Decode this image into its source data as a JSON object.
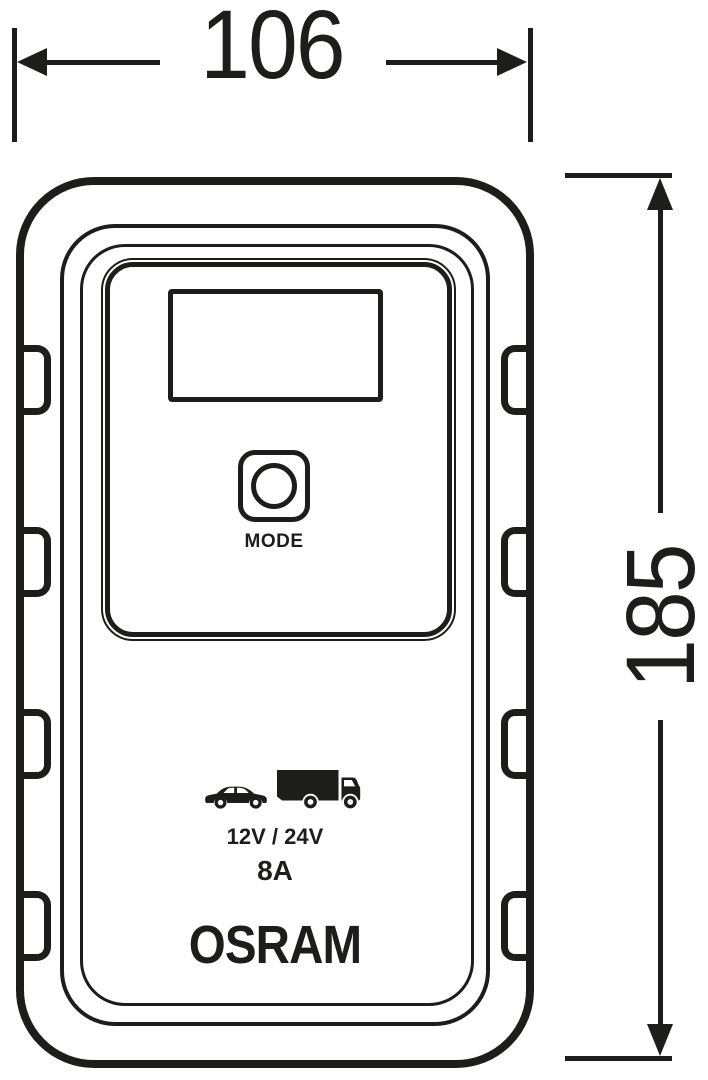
{
  "drawing": {
    "type": "technical dimension drawing, battery charger front view",
    "line_color": "#1d1d1b",
    "background_color": "#ffffff",
    "dimensions": {
      "width_label": "106",
      "height_label": "185"
    },
    "device": {
      "mode_button_label": "MODE",
      "voltage_label": "12V / 24V",
      "current_label": "8A",
      "brand": "OSRAM",
      "icons": [
        "car-icon",
        "truck-icon"
      ]
    }
  }
}
